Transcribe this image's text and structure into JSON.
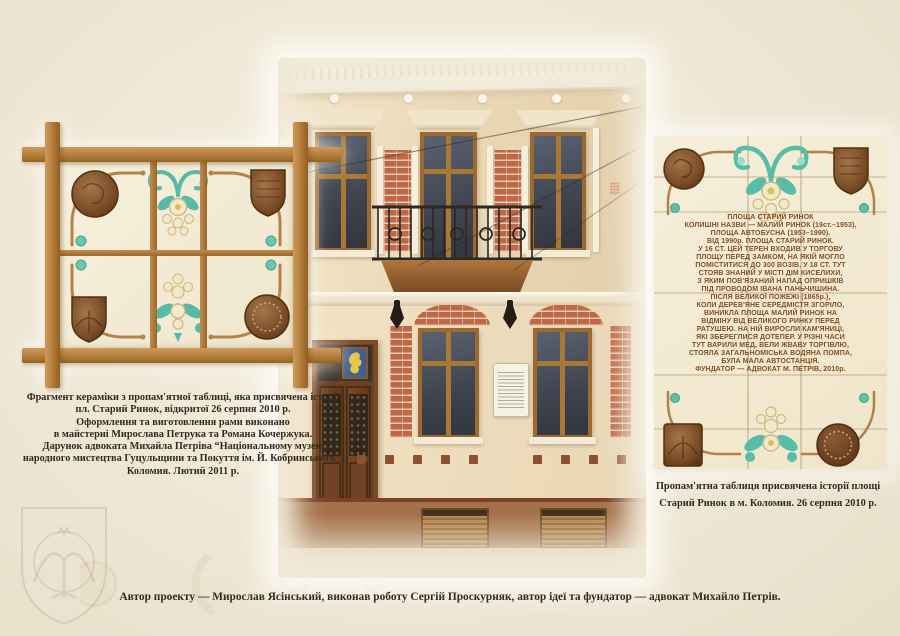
{
  "page": {
    "bottom_caption": "Автор проекту — Мирослав Ясінський, виконав роботу Сергій Проскурняк, автор ідеї та фундатор — адвокат Михайло Петрів."
  },
  "left_figure": {
    "caption_lines": [
      "Фрагмент кераміки з пропам'ятної таблиці, яка присвячена історії",
      "пл. Старий Ринок, відкритої 26 серпня 2010 р.",
      "Оформлення та виготовлення рами виконано",
      "в майстерні Мирослава Петрука та Романа Кочержука.",
      "Дарунок адвоката Михайла Петріва “Національному музею",
      "народного мистецтва Гуцульщини та Покуття ім. Й. Кобринського”.",
      "Коломия. Лютий 2011 р."
    ]
  },
  "memorial_plaque": {
    "lines": [
      "ПЛОЩА СТАРИЙ РИНОК",
      "КОЛИШНІ НАЗВИ — МАЛИЙ РИНОК (19ст.–1953),",
      "ПЛОЩА АВТОБУСНА (1953–1990).",
      "ВІД 1990р. ПЛОЩА СТАРИЙ РИНОК.",
      "У 16 СТ. ЦЕЙ ТЕРЕН ВХОДИВ У ТОРГОВУ",
      "ПЛОЩУ ПЕРЕД ЗАМКОМ, НА ЯКІЙ МОГЛО",
      "ПОМІСТИТИСЯ ДО 300 ВОЗІВ. У 18 СТ. ТУТ",
      "СТОЯВ ЗНАНИЙ У МІСТІ ДІМ КИСЕЛИХИ,",
      "З ЯКИМ ПОВ'ЯЗАНИЙ НАПАД ОПРИШКІВ",
      "ПІД ПРОВОДОМ ІВАНА ПАНЬЧИШИНА.",
      "ПІСЛЯ ВЕЛИКОЇ ПОЖЕЖІ (1865р.),",
      "КОЛИ ДЕРЕВ'ЯНЕ СЕРЕДМІСТЯ ЗГОРІЛО,",
      "ВИНИКЛА ПЛОЩА МАЛИЙ РИНОК НА",
      "ВІДМІНУ ВІД ВЕЛИКОГО РИНКУ ПЕРЕД",
      "РАТУШЕЮ. НА НІЙ ВИРОСЛИ КАМ'ЯНИЦІ,",
      "ЯКІ ЗБЕРЕГЛИСЯ ДОТЕПЕР. У РІЗНІ ЧАСИ",
      "ТУТ ВАРИЛИ МЕД, ВЕЛИ ЖВАВУ ТОРГІВЛЮ,",
      "СТОЯЛА ЗАГАЛЬНОМІСЬКА ВОДЯНА ПОМПА,",
      "БУЛА МАЛА АВТОСТАНЦІЯ.",
      "ФУНДАТОР — АДВОКАТ М. ПЕТРІВ, 2010р."
    ]
  },
  "right_figure": {
    "caption_lines": [
      "Пропам'ятна таблиця присвячена історії площі",
      "Старий Ринок в м. Коломия. 26 серпня 2010 р."
    ]
  },
  "colors": {
    "page_bg": "#f0e9d7",
    "wood_frame": "#b5803f",
    "ceramic": "#f2ebd5",
    "plaque_lettering": "#8a4b24",
    "teal_glaze": "#57bda6",
    "brick": "#bf6747",
    "caption_text": "#332b22"
  }
}
